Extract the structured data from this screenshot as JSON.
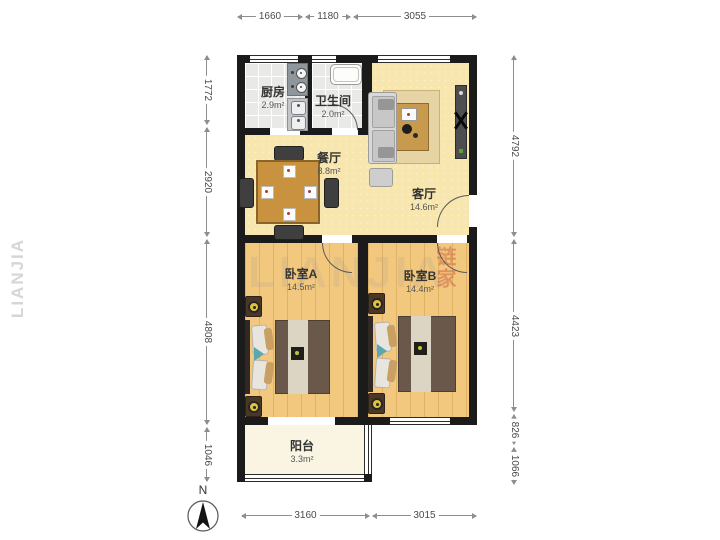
{
  "compass": {
    "label": "N"
  },
  "dimensions": {
    "top": [
      "1660",
      "1180",
      "3055"
    ],
    "bottom": [
      "3160",
      "3015"
    ],
    "left": [
      "1772",
      "2920",
      "4808",
      "1046"
    ],
    "right": [
      "4792",
      "4423",
      "826",
      "1066"
    ]
  },
  "rooms": {
    "kitchen": {
      "name": "厨房",
      "area": "2.9m²"
    },
    "bathroom": {
      "name": "卫生间",
      "area": "2.0m²"
    },
    "dining": {
      "name": "餐厅",
      "area": "8.8m²"
    },
    "living": {
      "name": "客厅",
      "area": "14.6m²"
    },
    "bedroom_a": {
      "name": "卧室A",
      "area": "14.5m²"
    },
    "bedroom_b": {
      "name": "卧室B",
      "area": "14.4m²"
    },
    "balcony": {
      "name": "阳台",
      "area": "3.3m²"
    }
  },
  "watermark": {
    "latin": "LIANJIA",
    "cn": "链家"
  },
  "colors": {
    "wall": "#1b1b1b",
    "wood_floor": "#f2c87f",
    "cream_floor": "#f7e6ae",
    "tile_floor": "#e9eae8",
    "balcony_floor": "#faf5e3",
    "dimension_text": "#4a4a4a",
    "watermark_red": "#c4462d"
  }
}
